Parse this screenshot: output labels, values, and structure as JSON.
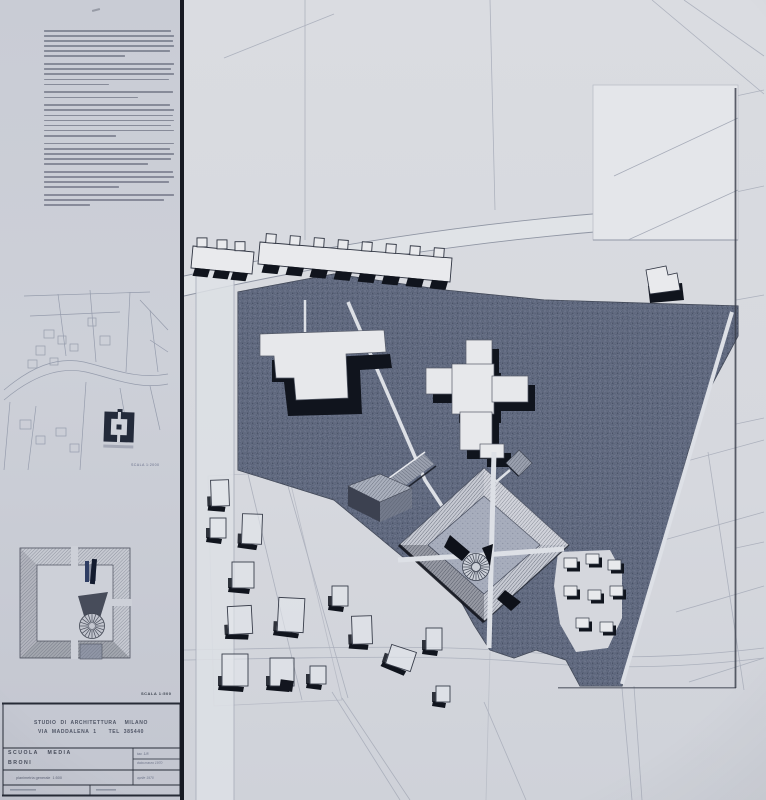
{
  "colors": {
    "board": "#c9ccd4",
    "paper": "#d8dade",
    "ink": "#2e3340",
    "dark_ground": "#49536a",
    "accent_blue": "#2e3d63"
  },
  "left_panel": {
    "typewritten_text": {
      "paragraph_line_widths": [
        [
          0.98,
          1,
          0.99,
          1,
          0.97,
          0.62
        ],
        [
          1,
          0.98,
          1,
          0.96,
          0.5
        ],
        [
          0.99,
          0.72
        ],
        [
          0.97,
          1,
          0.99,
          1,
          0.98,
          1,
          0.55
        ],
        [
          1,
          0.97,
          1,
          0.98,
          0.8
        ],
        [
          0.99,
          1,
          0.96,
          0.58
        ],
        [
          1,
          0.92,
          0.35
        ]
      ]
    },
    "site_map": {
      "scale_label": "SCALA 1:2000"
    },
    "axon_plan": {
      "scale_label": "SCALA 1:500"
    },
    "title_block": {
      "studio_line1": "STUDIO  DI  ARCHITETTURA    MILANO",
      "studio_line2": "VIA  MADDALENA  1      TEL  385440",
      "project": "SCUOLA   MEDIA",
      "location": "BRONI",
      "sheet_label": "tav. 1/8",
      "date_label": "data marzo 1970",
      "drawing_title": "planimetria generale  1:500",
      "approval_label": "aprile 1970"
    }
  }
}
